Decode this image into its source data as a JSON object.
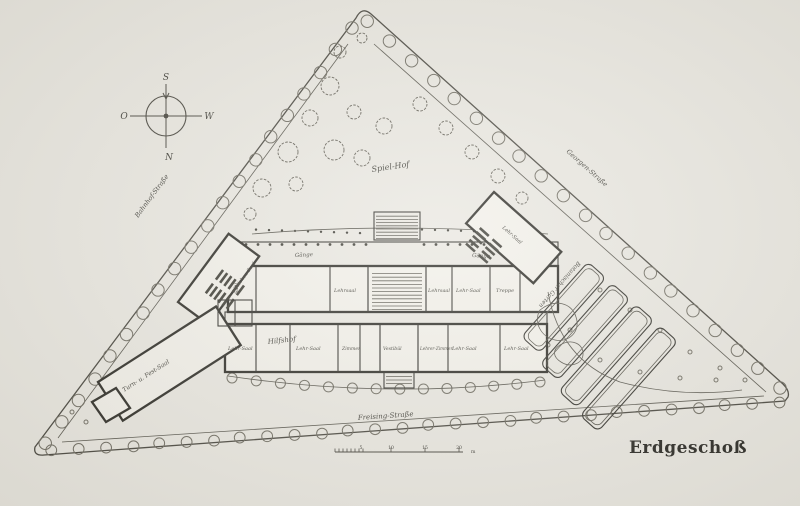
{
  "figure": {
    "caption": "Erdgeschoß"
  },
  "compass": {
    "top": "S",
    "bottom": "N",
    "left": "O",
    "right": "W"
  },
  "streets": {
    "left": "Bahnhof-Straße",
    "right": "Georgen-Straße",
    "bottom": "Freising-Straße"
  },
  "areas": {
    "courtyard": "Spiel-Hof",
    "service_yard": "Hilfshof",
    "garden": "Botanischer Garten",
    "hall": "Turn- u. Fest-Saal"
  },
  "corridors": {
    "left": "Gänge",
    "right": "Gänge"
  },
  "rooms": {
    "saal": "Saal",
    "zeichensaal": "Zeichen-Saal",
    "u1": "Lehrsaal",
    "u2": "Lehrsaal",
    "u3": "Lehr-Saal",
    "r_annex": "Lehr-Saal",
    "treppe_r": "Treppe",
    "l1": "Lehr-Saal",
    "l2": "Lehr-Saal",
    "zimmer": "Zimmer",
    "vestibuel": "Vestibül",
    "lehrerzimmer": "Lehrer-Zimmer",
    "l3": "Lehr-Saal",
    "l4": "Lehr-Saal"
  },
  "scale": {
    "t1": "5",
    "t2": "10",
    "t3": "15",
    "t4": "20",
    "unit": "m"
  }
}
